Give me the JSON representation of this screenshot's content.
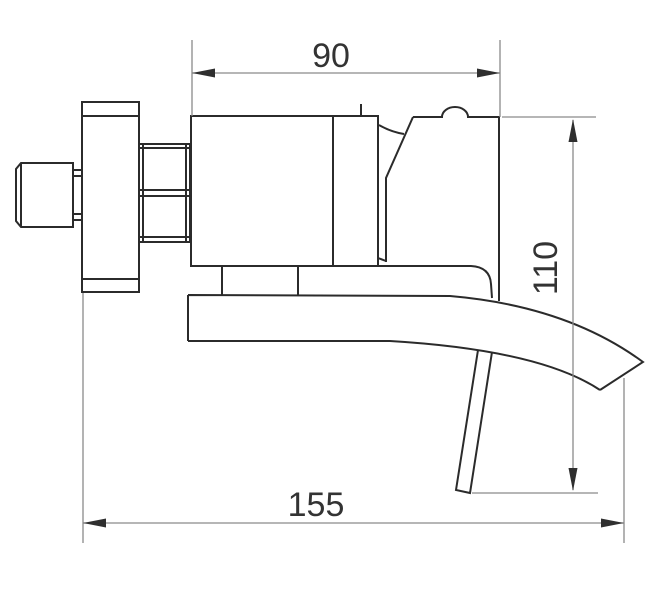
{
  "drawing": {
    "dimensions": {
      "top_width": {
        "label": "90"
      },
      "right_height": {
        "label": "110"
      },
      "bottom_width": {
        "label": "155"
      }
    },
    "colors": {
      "background": "#ffffff",
      "object_line": "#2b2b2b",
      "dimension_line": "#8a8a8a",
      "arrowhead": "#2f2f2f",
      "text": "#333333"
    }
  }
}
